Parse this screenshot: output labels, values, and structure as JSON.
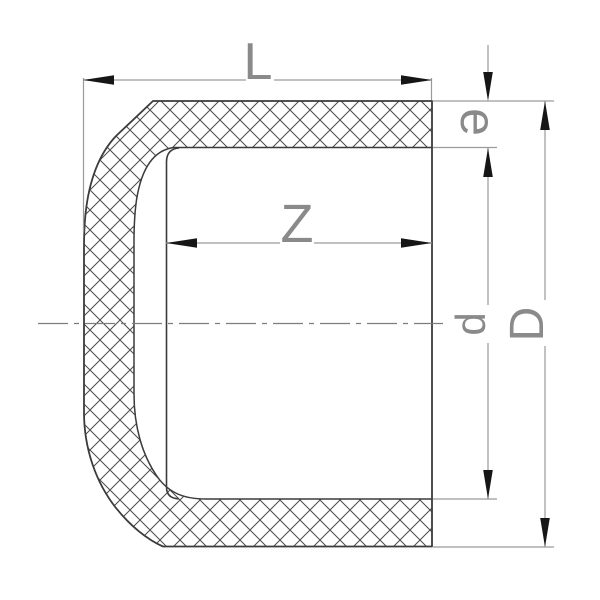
{
  "diagram": {
    "type": "engineering-section-drawing",
    "subject": "pipe-end-cap-cross-section",
    "dimension_labels": {
      "overall_length": "L",
      "socket_depth": "Z",
      "wall_thickness": "e",
      "inner_diameter": "d",
      "outer_diameter": "D"
    },
    "colors": {
      "background": "#ffffff",
      "part_outline": "#3b3b3b",
      "hatch_line": "#4a4a4a",
      "dimension_line": "#9a9a9a",
      "center_line": "#7d7d7d",
      "arrow": "#161616",
      "label_text": "#8a8a8a"
    }
  }
}
